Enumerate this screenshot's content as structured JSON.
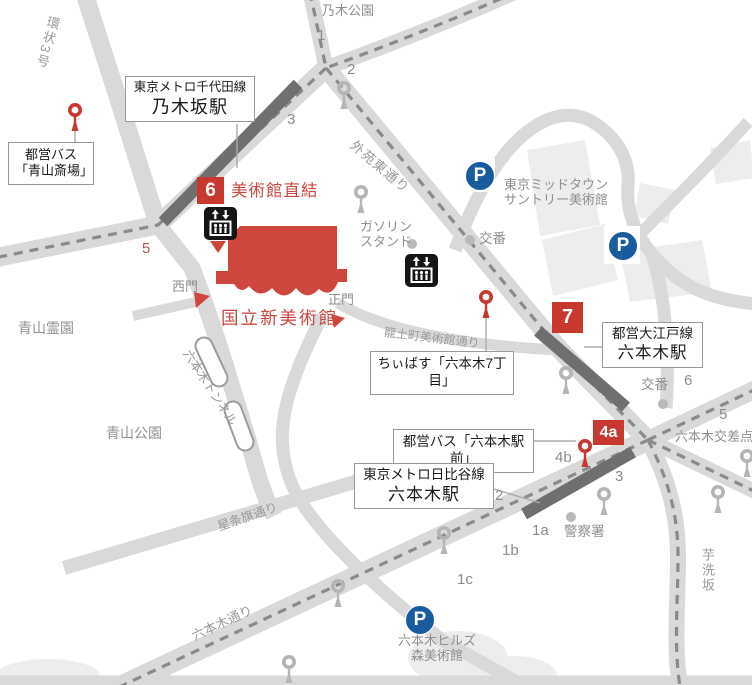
{
  "colors": {
    "road": "#d9d9d9",
    "road_dash": "#8a8a8a",
    "station_bar": "#6f6f6f",
    "building": "#ededed",
    "museum_red": "#cf463f",
    "badge_red": "#c7392f",
    "parking_blue": "#1a5a9e",
    "icon_gray": "#b5b5b5",
    "label_gray": "#8f8f8f"
  },
  "map": {
    "museum": {
      "name": "国立新美術館",
      "direct_label": "美術館直結",
      "west_gate": "西門",
      "main_gate": "正門"
    },
    "stations": {
      "nogizaka": {
        "line": "東京メトロ千代田線",
        "name": "乃木坂駅"
      },
      "hibiya": {
        "line": "東京メトロ日比谷線",
        "name": "六本木駅"
      },
      "oedo": {
        "line": "都営大江戸線",
        "name": "六本木駅"
      }
    },
    "bus_stops": {
      "aoyama": {
        "line1": "都営バス",
        "line2": "「青山斎場」"
      },
      "chiibus": {
        "label": "ちぃばす「六本木7丁目」"
      },
      "roppongi": {
        "label": "都営バス「六本木駅前」"
      }
    },
    "badges": {
      "exit6": "6",
      "exit7": "7",
      "exit4a": "4a"
    },
    "exits": {
      "n1": "1",
      "n2": "2",
      "n3": "3",
      "n5": "5",
      "o6": "6",
      "o5": "5",
      "o4b": "4b",
      "o3": "3",
      "h2": "2",
      "h1a": "1a",
      "h1b": "1b",
      "h1c": "1c"
    },
    "roads": {
      "kanjo3": "環状3号",
      "gaien_higashi_dori": "外苑東通り",
      "ryudocho_bijutsukan_dori": "龍土町美術館通り",
      "roppongi_tunnel": "六本木トンネル",
      "seijoki_dori": "星条旗通り",
      "roppongi_dori": "六本木通り",
      "imoarai_zaka": "芋洗坂",
      "roppongi_crossing": "六本木交差点"
    },
    "places": {
      "nogi_park": "乃木公園",
      "aoyama_cemetery": "青山霊園",
      "aoyama_park": "青山公園",
      "midtown_line1": "東京ミッドタウン",
      "midtown_line2": "サントリー美術館",
      "hills_line1": "六本木ヒルズ",
      "hills_line2": "森美術館",
      "gas_line1": "ガソリン",
      "gas_line2": "スタンド",
      "koban_center": "交番",
      "koban_east": "交番",
      "police": "警察署"
    },
    "parking_label": "P"
  }
}
